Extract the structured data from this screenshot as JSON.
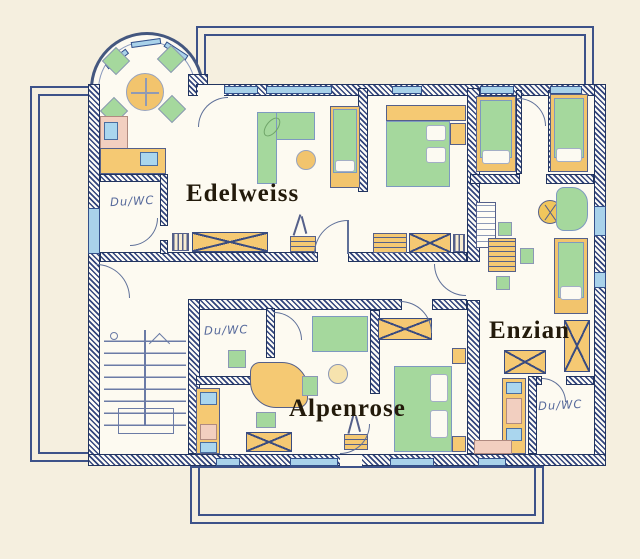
{
  "plan": {
    "type": "hand-drawn apartment floor plan",
    "apartments": [
      {
        "id": "edelweiss",
        "label": "Edelweiss",
        "bath_label": "Du/WC"
      },
      {
        "id": "alpenrose",
        "label": "Alpenrose",
        "bath_label": "Du/WC"
      },
      {
        "id": "enzian",
        "label": "Enzian",
        "bath_label": "Du/WC"
      }
    ]
  },
  "colors": {
    "paper": "#f5efdf",
    "floor": "#fdfaf1",
    "wall_ink": "#33457d",
    "window_blue": "#a9d2ea",
    "furniture_orange": "#f5c973",
    "furniture_green": "#a5d89d",
    "furniture_pink": "#f2cfc0",
    "appliance_blue": "#aad6ee",
    "balcony_line": "#3d5289",
    "label_ink": "#231a0b",
    "hand_ink": "#56699b"
  },
  "symbols": {
    "door": "quarter-arc",
    "window": "blue-strip",
    "wardrobe": "x-crossed-box",
    "stairs": "parallel-treads",
    "round_table": "circle-with-cross",
    "radiator": "striped-box"
  }
}
